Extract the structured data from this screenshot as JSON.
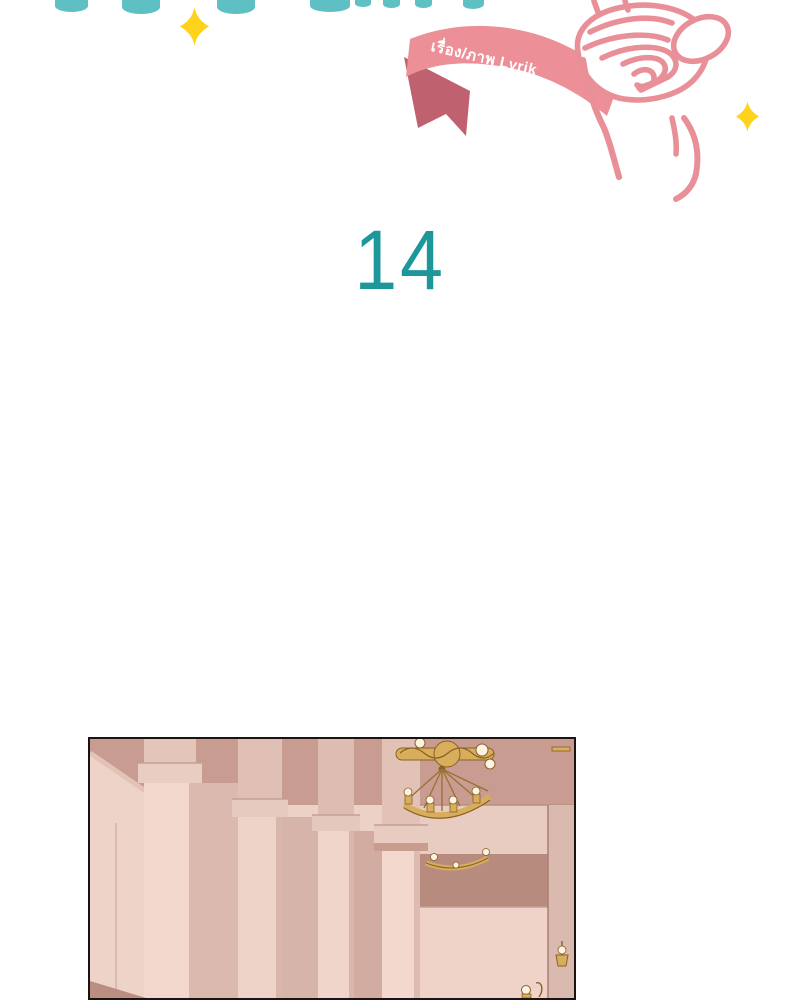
{
  "header": {
    "title_note": "",
    "credit_ribbon": {
      "text": "เรื่อง/ภาพ Lyrik"
    }
  },
  "chapter": {
    "number": "14"
  },
  "icons": {
    "sparkle": "four-point-star",
    "finger_heart": "finger-heart-hand",
    "chandelier": "gold-chandelier",
    "wall_sconce": "gold-wall-sconce"
  },
  "colors": {
    "teal_light": "#5fc0c4",
    "teal_dark": "#1e979b",
    "pink_line": "#e98f98",
    "ribbon_pink": "#ec8f96",
    "ribbon_fold": "#c06170",
    "sparkle_yellow": "#ffd21c",
    "gold": "#d8ad5b",
    "gold_dark": "#8a6128",
    "bulb_cream": "#fdf3e3",
    "panel_bg": "#ecd1c7",
    "ceiling_rose": "#c89c90",
    "band_dark": "#b88b7f",
    "wall_light": "#e9ccc1",
    "column_light": "#f1d7cc",
    "column_mid": "#dcb9ae"
  }
}
